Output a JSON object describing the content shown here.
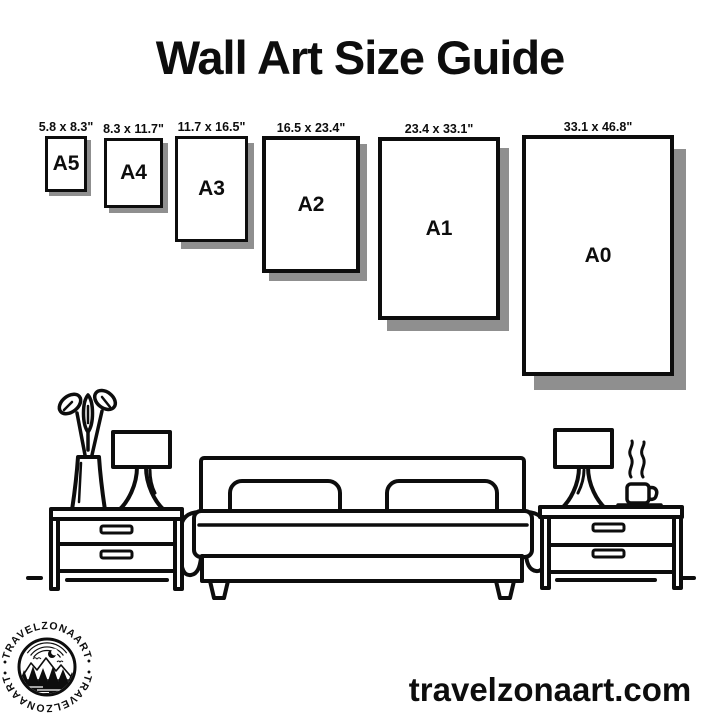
{
  "title": "Wall Art Size Guide",
  "website": "travelzonaart.com",
  "logo": {
    "top_text": "•TRAVELZONAART•",
    "bottom_text": "•TRAVELZONAART•"
  },
  "sizes": [
    {
      "label": "A5",
      "dimensions": "5.8 x 8.3\""
    },
    {
      "label": "A4",
      "dimensions": "8.3 x 11.7\""
    },
    {
      "label": "A3",
      "dimensions": "11.7 x 16.5\""
    },
    {
      "label": "A2",
      "dimensions": "16.5 x 23.4\""
    },
    {
      "label": "A1",
      "dimensions": "23.4 x 33.1\""
    },
    {
      "label": "A0",
      "dimensions": "33.1 x 46.8\""
    }
  ],
  "illustration": {
    "scene": "bedroom",
    "items": [
      "plant-vase-icon",
      "table-lamp-icon",
      "nightstand-icon",
      "bed-icon",
      "table-lamp-icon",
      "coffee-cup-icon",
      "nightstand-icon"
    ]
  },
  "colors": {
    "ink": "#0d0d0d",
    "paper_shadow": "#8f8f8f",
    "background": "#ffffff"
  }
}
